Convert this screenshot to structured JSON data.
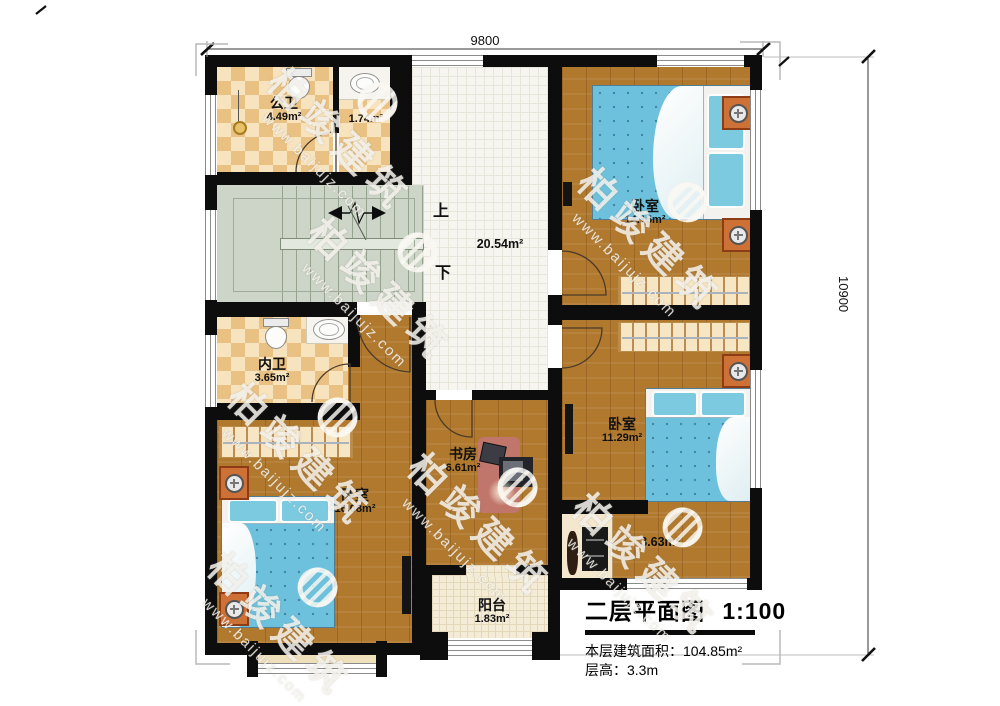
{
  "dimensions": {
    "top": "9800",
    "right": "10900"
  },
  "stair_labels": {
    "up": "上",
    "down": "下"
  },
  "rooms": {
    "public_bath": {
      "name": "公卫",
      "area": "4.49m²"
    },
    "shower_room": {
      "area": "1.74m²"
    },
    "hallway": {
      "area": "20.54m²"
    },
    "bedroom_top_right": {
      "name": "卧室",
      "area": "14.15m²"
    },
    "ensuite_bath": {
      "name": "内卫",
      "area": "3.65m²"
    },
    "study": {
      "name": "书房",
      "area": "6.61m²"
    },
    "bedroom_mid_right": {
      "name": "卧室",
      "area": "11.29m²"
    },
    "bedroom_bottom_left": {
      "name": "卧室",
      "area": "16.08m²"
    },
    "corridor": {
      "area": "3.63m²"
    },
    "balcony": {
      "name": "阳台",
      "area": "1.83m²"
    }
  },
  "title_block": {
    "title": "二层平面图",
    "scale": "1:100",
    "area_line": "本层建筑面积：104.85m²",
    "height_line": "层高：3.3m"
  },
  "watermark": {
    "brand": "柏竣建筑",
    "url": "www.baijujz.com"
  },
  "colors": {
    "wall": "#0d0d0d",
    "wood": "#b0792e",
    "tile": "#e9c183",
    "stairs": "#ccd5c8",
    "bed": "#6ec1dc",
    "nightstand": "#cd7136"
  }
}
